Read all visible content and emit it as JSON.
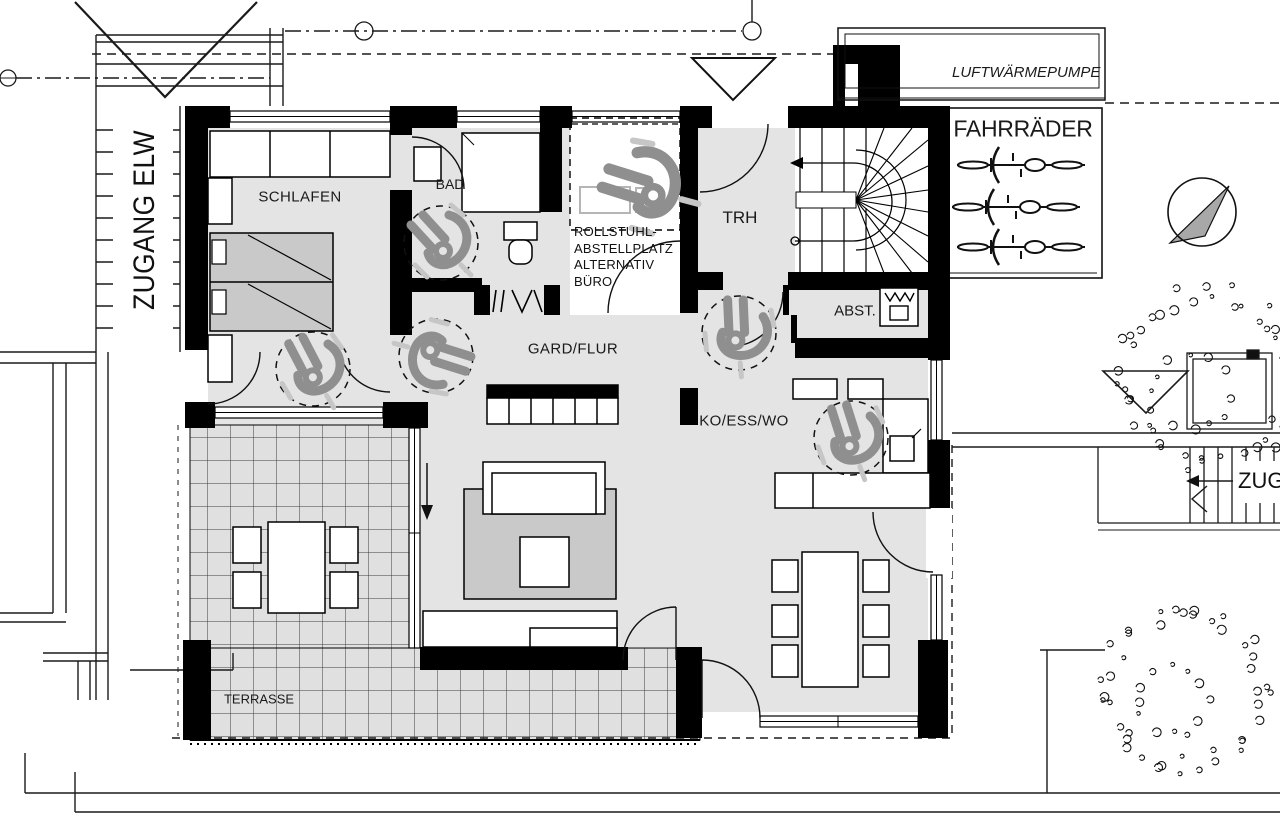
{
  "plan": {
    "rooms": {
      "schlafen": "SCHLAFEN",
      "bad": "BAD",
      "trh": "TRH",
      "abst": "ABST.",
      "gard_flur": "GARD/FLUR",
      "ko_ess_wo": "KO/ESS/WO",
      "terrasse": "TERRASSE"
    },
    "annotations": {
      "zugang_elw": "ZUGANG ELW",
      "luftwaermepumpe": "LUFTWÄRMEPUMPE",
      "fahrraeder": "FAHRRÄDER",
      "zugang": "ZUGANG",
      "rollstuhl_lines": [
        "ROLLSTUHL-",
        "ABSTELLPLATZ",
        "ALTERNATIV",
        "BÜRO"
      ]
    },
    "colors": {
      "floor": "#e4e4e4",
      "furniture_gray": "#c9c9c9",
      "tile_floor": "#e0e0e0",
      "icon_gray": "#8f8f8f",
      "light_gray": "#c6c6c6"
    }
  }
}
